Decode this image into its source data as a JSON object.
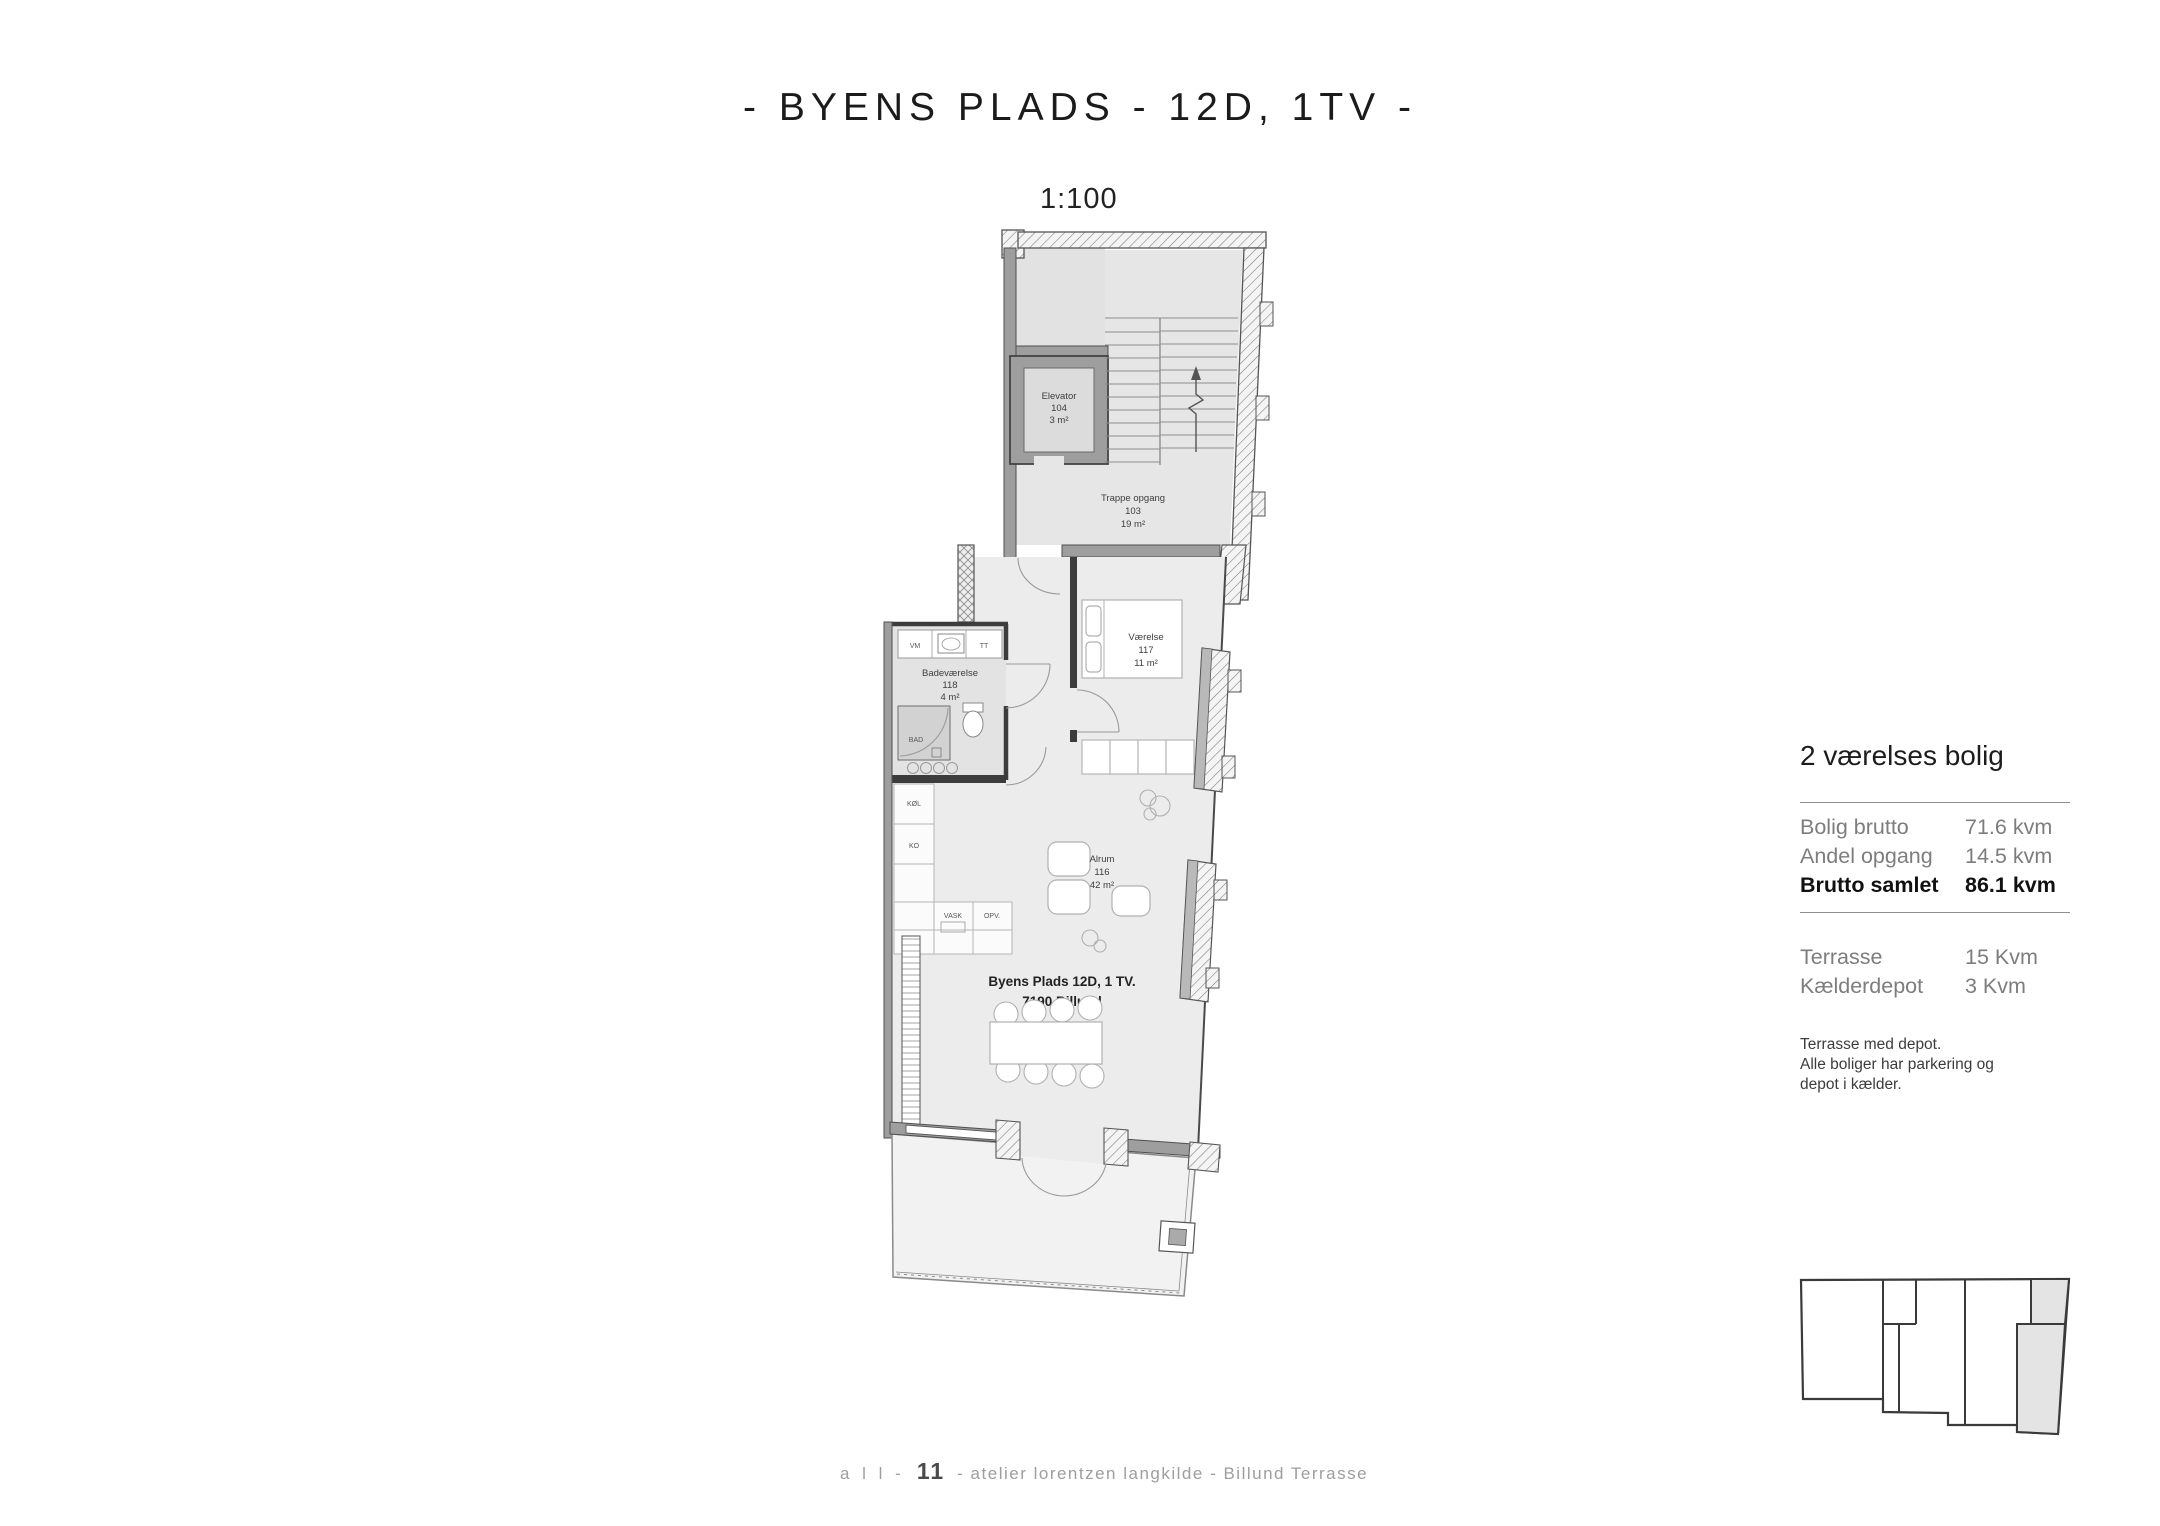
{
  "page": {
    "title": "- BYENS PLADS - 12D, 1TV -",
    "scale": "1:100"
  },
  "plan": {
    "rooms": {
      "elevator": {
        "name": "Elevator",
        "number": "104",
        "area": "3 m²"
      },
      "stairs": {
        "name": "Trappe opgang",
        "number": "103",
        "area": "19 m²"
      },
      "bedroom": {
        "name": "Værelse",
        "number": "117",
        "area": "11 m²"
      },
      "bathroom": {
        "name": "Badeværelse",
        "number": "118",
        "area": "4 m²"
      },
      "living": {
        "name": "Alrum",
        "number": "116",
        "area": "42 m²"
      }
    },
    "fixtures": {
      "vm": "VM",
      "tt": "TT",
      "bad": "BAD",
      "kol": "KØL",
      "ko": "KO",
      "vask": "VASK",
      "opv": "OPV."
    },
    "address_line1": "Byens Plads 12D, 1 TV.",
    "address_line2": "7190 Billund"
  },
  "info_panel": {
    "heading": "2 værelses bolig",
    "rows": [
      {
        "label": "Bolig brutto",
        "value": "71.6 kvm"
      },
      {
        "label": "Andel opgang",
        "value": "14.5 kvm"
      },
      {
        "label": "Brutto samlet",
        "value": "86.1 kvm"
      }
    ],
    "rows2": [
      {
        "label": "Terrasse",
        "value": "15 Kvm"
      },
      {
        "label": "Kælderdepot",
        "value": "3 Kvm"
      }
    ],
    "note_lines": [
      "Terrasse med depot.",
      "Alle boliger har parkering og",
      "depot i kælder."
    ]
  },
  "footer": {
    "part1": "a l l -",
    "part2": "11",
    "part3": "- atelier lorentzen langkilde - Billund Terrasse"
  },
  "colors": {
    "wall_gray": "#9e9e9e",
    "room_fill": "#e9e9e9",
    "terrace_fill": "#f2f2f2",
    "outline_dark": "#3c3c3c",
    "keyplan_highlight": "#e4e4e4"
  }
}
